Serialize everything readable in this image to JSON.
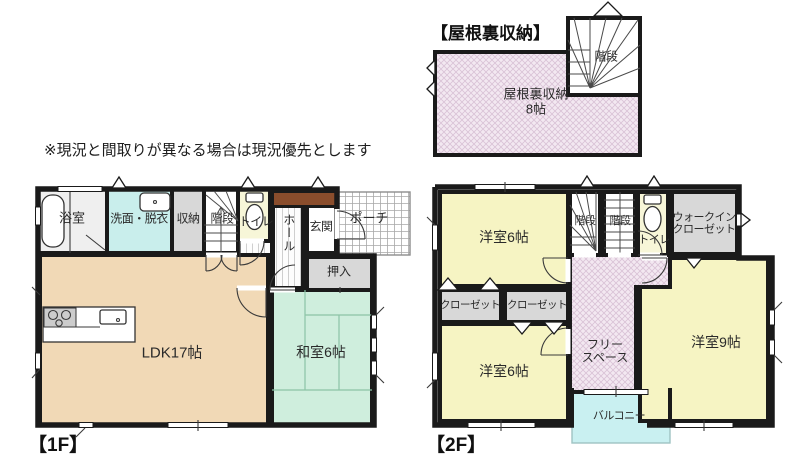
{
  "note": "※現況と間取りが異なる場合は現況優先とします",
  "attic": {
    "title": "【屋根裏収納】",
    "storage_line1": "屋根裏収納",
    "storage_line2": "8帖",
    "stairs": "階段"
  },
  "f1": {
    "title": "【1F】",
    "bath": "浴室",
    "washroom": "洗面・脱衣",
    "storage": "収納",
    "stairs": "階段",
    "toilet": "トイレ",
    "hall": "ホール",
    "entrance": "玄関",
    "porch": "ポーチ",
    "oshiire": "押入",
    "ldk": "LDK17帖",
    "washitsu": "和室6帖"
  },
  "f2": {
    "title": "【2F】",
    "bedroom_nw": "洋室6帖",
    "closet_left": "クローゼット",
    "closet_mid": "クローゼット",
    "bedroom_sw": "洋室6帖",
    "stairs_down": "階段",
    "stairs_up": "階段",
    "toilet": "トイレ",
    "wic_line1": "ウォークイン",
    "wic_line2": "クローゼット",
    "free_line1": "フリー",
    "free_line2": "スペース",
    "bedroom_e": "洋室9帖",
    "balcony": "バルコニー"
  },
  "colors": {
    "wall": "#1a1a1a",
    "ldk": "#f1d9b6",
    "washitsu": "#cfeedd",
    "bedroom": "#f6f4c3",
    "toilet_room": "#f7f6d8",
    "washroom": "#c9eeec",
    "balcony": "#c9f0f1",
    "closet": "#d8d8d8",
    "bath": "#efefef",
    "hatch_bg": "#f3e8f1",
    "hatch_line": "#d9c2d6",
    "cabinet": "#8a4d2c",
    "tatami_line": "#8cc3a6"
  }
}
